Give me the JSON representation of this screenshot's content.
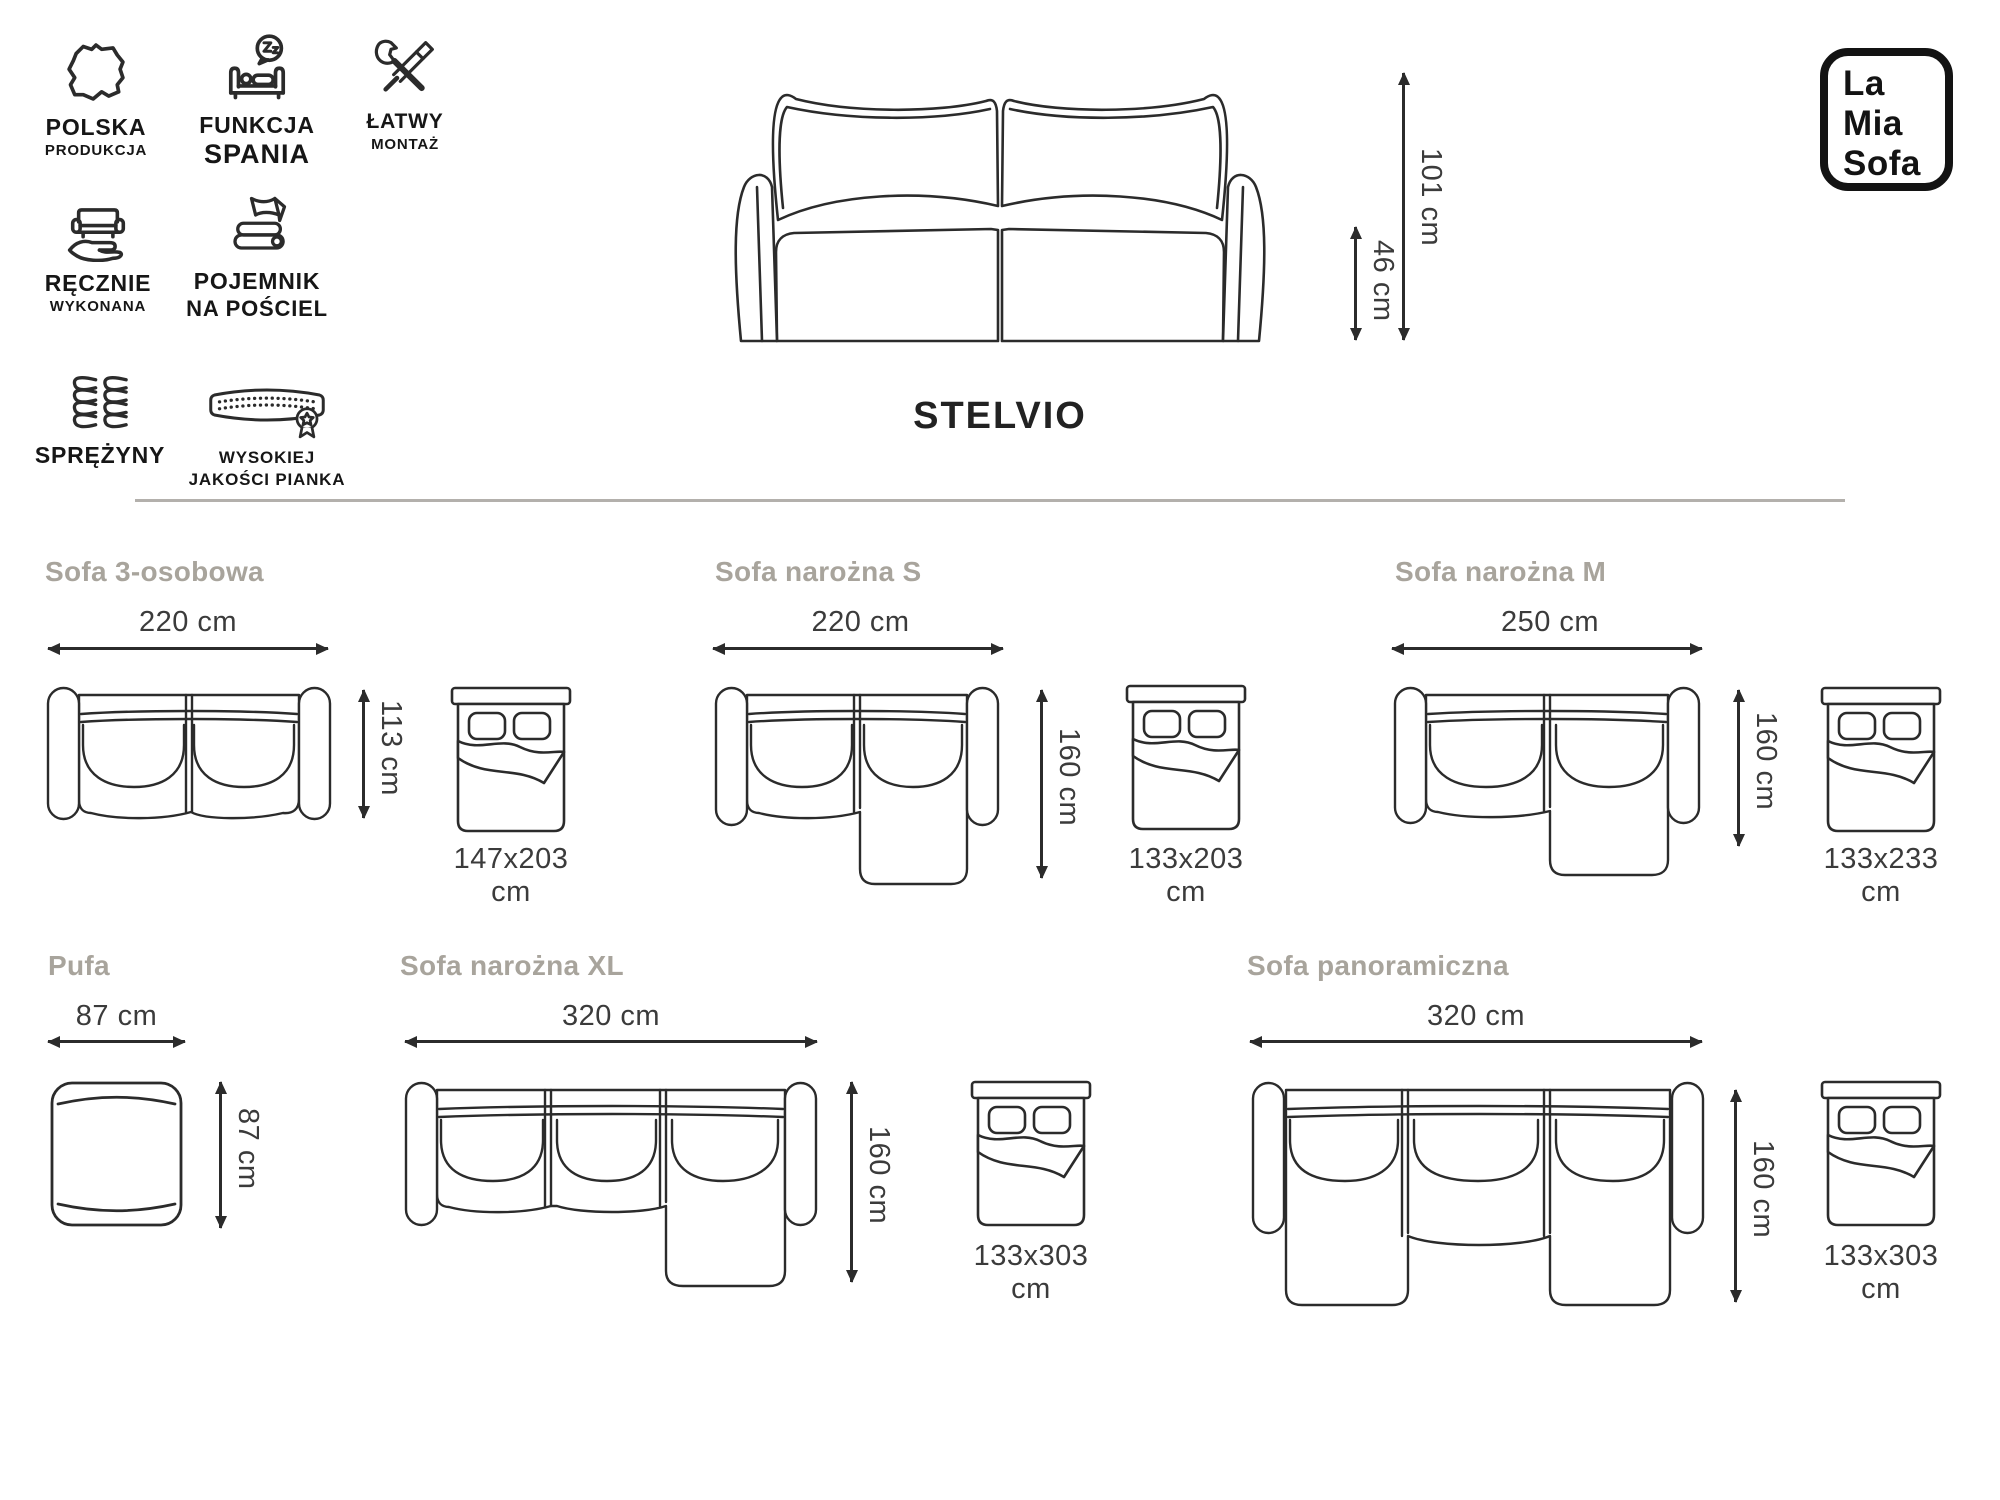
{
  "logo": {
    "line1": "La",
    "line2": "Mia",
    "line3": "Sofa"
  },
  "product": {
    "name": "STELVIO",
    "height": "101 cm",
    "seat_height": "46 cm"
  },
  "features": [
    {
      "icon": "poland-map",
      "line1": "POLSKA",
      "line2": "PRODUKCJA"
    },
    {
      "icon": "sleep-function",
      "line1": "FUNKCJA",
      "line2": "SPANIA"
    },
    {
      "icon": "easy-assembly",
      "line1": "ŁATWY",
      "line2": "MONTAŻ"
    },
    {
      "icon": "handmade",
      "line1": "RĘCZNIE",
      "line2": "WYKONANA"
    },
    {
      "icon": "bedding-storage",
      "line1": "POJEMNIK",
      "line2": "NA POŚCIEL"
    },
    {
      "icon": "springs",
      "line1": "SPRĘŻYNY",
      "line2": ""
    },
    {
      "icon": "high-quality-foam",
      "line1": "WYSOKIEJ",
      "line2": "JAKOŚCI PIANKA"
    }
  ],
  "variants": [
    {
      "title": "Sofa 3-osobowa",
      "width": "220 cm",
      "depth": "113 cm",
      "bed_size": "147x203 cm"
    },
    {
      "title": "Sofa narożna S",
      "width": "220 cm",
      "depth": "160 cm",
      "bed_size": "133x203 cm"
    },
    {
      "title": "Sofa narożna M",
      "width": "250 cm",
      "depth": "160 cm",
      "bed_size": "133x233 cm"
    },
    {
      "title": "Pufa",
      "width": "87 cm",
      "depth": "87 cm"
    },
    {
      "title": "Sofa narożna XL",
      "width": "320 cm",
      "depth": "160 cm",
      "bed_size": "133x303 cm"
    },
    {
      "title": "Sofa panoramiczna",
      "width": "320 cm",
      "depth": "160 cm",
      "bed_size": "133x303 cm"
    }
  ],
  "colors": {
    "line": "#2b2b2b",
    "section_title": "#a8a49c",
    "dimension_text": "#3b3b3b",
    "divider": "#b3b0ac"
  }
}
